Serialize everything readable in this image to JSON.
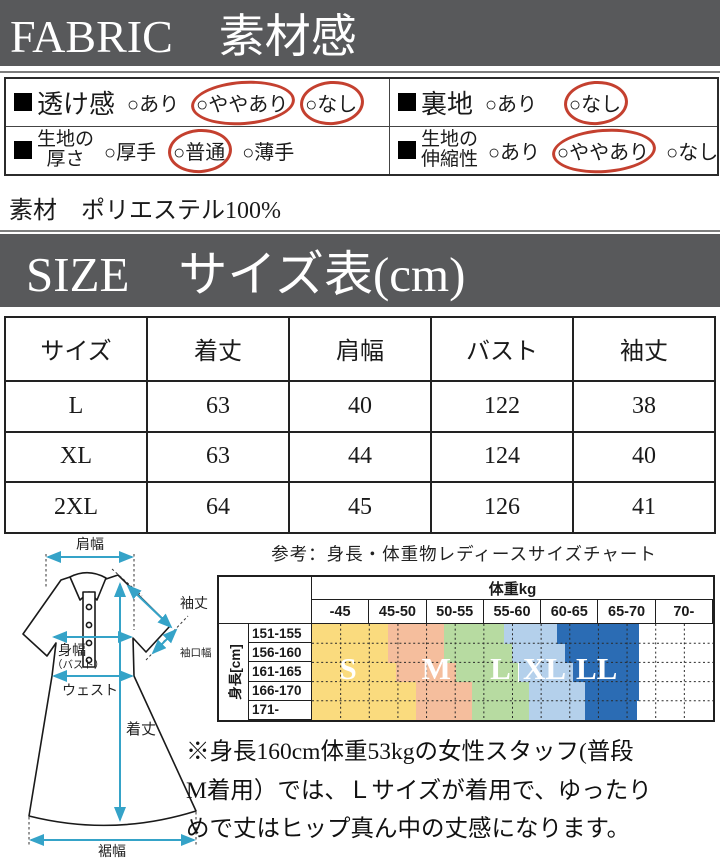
{
  "fabric_section": {
    "banner": "FABRIC　素材感",
    "rows": [
      {
        "label": "透け感",
        "options": [
          "○あり",
          "○ややあり",
          "○なし"
        ]
      },
      {
        "label": "裏地",
        "options": [
          "○あり",
          "○なし"
        ]
      },
      {
        "label_line1": "生地の",
        "label_line2": "厚さ",
        "options": [
          "○厚手",
          "○普通",
          "○薄手"
        ]
      },
      {
        "label_line1": "生地の",
        "label_line2": "伸縮性",
        "options": [
          "○あり",
          "○ややあり",
          "○なし"
        ]
      }
    ],
    "material": "素材　ポリエステル100%"
  },
  "size_section": {
    "banner": "SIZE　サイズ表(cm)",
    "headers": [
      "サイズ",
      "着丈",
      "肩幅",
      "バスト",
      "袖丈"
    ],
    "rows": [
      [
        "L",
        "63",
        "40",
        "122",
        "38"
      ],
      [
        "XL",
        "63",
        "44",
        "124",
        "40"
      ],
      [
        "2XL",
        "64",
        "45",
        "126",
        "41"
      ]
    ]
  },
  "diagram": {
    "labels": {
      "shoulder": "肩幅",
      "sleeve": "袖丈",
      "cuff": "袖口幅",
      "bust1": "身幅",
      "bust2": "（バスト）",
      "waist": "ウェスト",
      "length": "着丈",
      "hem": "裾幅"
    },
    "arrow_color": "#35a3c8"
  },
  "chart_data": {
    "type": "heatmap",
    "caption": "参考：身長・体重物レディースサイズチャート",
    "x_axis": {
      "header": "体重kg",
      "cols": [
        "-45",
        "45-50",
        "50-55",
        "55-60",
        "60-65",
        "65-70",
        "70-"
      ]
    },
    "y_axis": {
      "header": "身長[cm]",
      "rows": [
        "151-155",
        "156-160",
        "161-165",
        "166-170",
        "171-"
      ]
    },
    "sizes": [
      {
        "label": "S",
        "color": "#FADB7E",
        "center_pct": 9
      },
      {
        "label": "M",
        "color": "#F5BE9D",
        "center_pct": 31
      },
      {
        "label": "L",
        "color": "#B7DBA1",
        "center_pct": 47
      },
      {
        "label": "XL",
        "color": "#B4D0EB",
        "center_pct": 58
      },
      {
        "label": "LL",
        "color": "#2B6CB4",
        "center_pct": 71
      }
    ],
    "band_colors": [
      "#FADB7E",
      "#F5BE9D",
      "#B7DBA1",
      "#B4D0EB",
      "#2B6CB4",
      "#FFFFFF"
    ],
    "row_band_boundaries_pct": [
      [
        0,
        19,
        33,
        48,
        61,
        81.5,
        100
      ],
      [
        0,
        19,
        33,
        50,
        63,
        81.5,
        100
      ],
      [
        0,
        21,
        36,
        51.5,
        65,
        81.5,
        100
      ],
      [
        0,
        26,
        40,
        54,
        68,
        81.5,
        100
      ],
      [
        0,
        26,
        40,
        54,
        68,
        81,
        100
      ]
    ]
  },
  "note_lines": [
    "※身長160cm体重53kgの女性スタッフ(普段",
    "M着用）では、Ｌサイズが着用で、ゆったり",
    "めで丈はヒップ真ん中の丈感になります。"
  ]
}
